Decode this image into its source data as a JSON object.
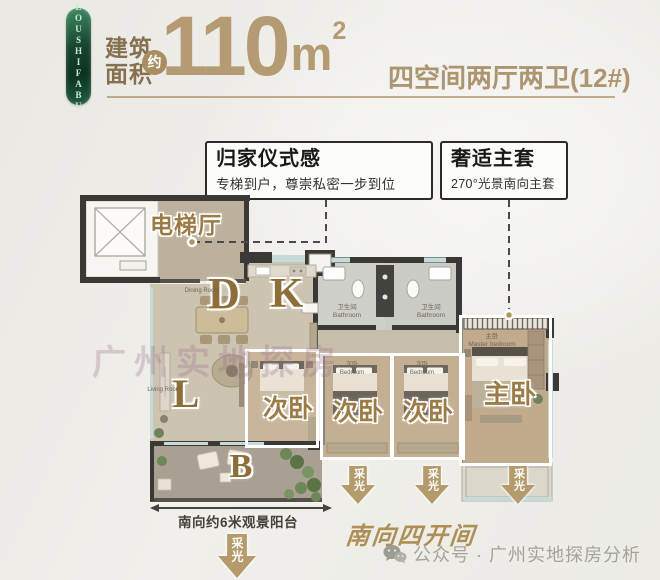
{
  "badge": {
    "text": "LOUSHIFABU"
  },
  "header": {
    "area_label_line1": "建筑",
    "area_label_line2": "面积",
    "approx_badge": "约",
    "area_value": "110",
    "area_unit": "m",
    "area_exponent": "2",
    "spec": "四空间两厅两卫(12#)"
  },
  "callouts": {
    "homecoming": {
      "title": "归家仪式感",
      "desc": "专梯到户，尊崇私密一步到位"
    },
    "master_suite": {
      "title": "奢适主套",
      "desc": "270°光景南向主套"
    }
  },
  "floorplan": {
    "elevator_hall": "电梯厅",
    "dining_letter": "D",
    "dining_en": "Dining Room",
    "kitchen_letter": "K",
    "living_letter": "L",
    "living_en": "Living Room",
    "balcony_letter": "B",
    "bathroom_cn": "卫生间",
    "bathroom_en": "Bathroom",
    "secondary_bedroom": "次卧",
    "secondary_bedroom_en": "Bedroom",
    "master_bedroom": "主卧",
    "master_small_cn": "主卧",
    "master_small_en": "Master bedroom",
    "daylight": "采光",
    "balcony_dim": "南向约6米观景阳台"
  },
  "footer": {
    "south_orientation": "南向四开间",
    "credit": "公众号 · 广州实地探房分析"
  },
  "watermark": "广州实地探房",
  "colors": {
    "accent_gold": "#b49b73",
    "label_gold": "#9c7c46",
    "badge_green": "#14503a",
    "wall_dark": "#3a3936",
    "window_blue": "#c5dbda"
  }
}
